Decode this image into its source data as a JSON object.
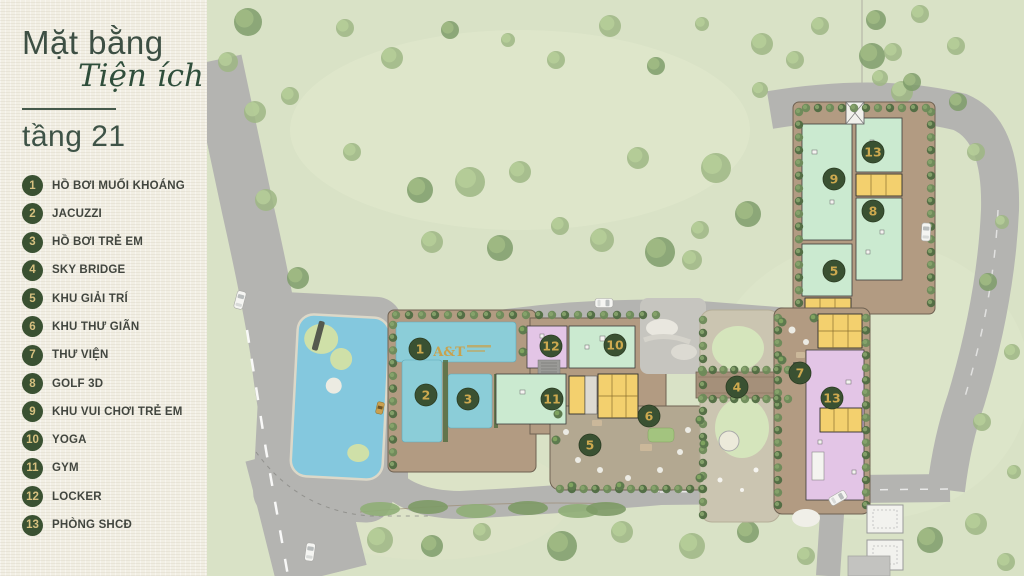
{
  "panel": {
    "title_line1": "Mặt bằng",
    "title_line2": "Tiện ích",
    "floor": "tầng 21",
    "items": [
      {
        "number": "1",
        "label": "HỒ BƠI MUỐI KHOÁNG"
      },
      {
        "number": "2",
        "label": "JACUZZI"
      },
      {
        "number": "3",
        "label": "HỒ BƠI TRẺ EM"
      },
      {
        "number": "4",
        "label": "SKY BRIDGE"
      },
      {
        "number": "5",
        "label": "KHU GIẢI TRÍ"
      },
      {
        "number": "6",
        "label": "KHU THƯ GIÃN"
      },
      {
        "number": "7",
        "label": "THƯ VIỆN"
      },
      {
        "number": "8",
        "label": "GOLF 3D"
      },
      {
        "number": "9",
        "label": "KHU VUI CHƠI TRẺ EM"
      },
      {
        "number": "10",
        "label": "YOGA"
      },
      {
        "number": "11",
        "label": "GYM"
      },
      {
        "number": "12",
        "label": "LOCKER"
      },
      {
        "number": "13",
        "label": "PHÒNG SHCĐ"
      }
    ]
  },
  "map": {
    "pool_logo": "A&T",
    "markers": [
      {
        "number": "1",
        "area": "ho-boi-muoi-khoang"
      },
      {
        "number": "2",
        "area": "jacuzzi"
      },
      {
        "number": "3",
        "area": "ho-boi-tre-em"
      },
      {
        "number": "12",
        "area": "locker"
      },
      {
        "number": "10",
        "area": "yoga"
      },
      {
        "number": "11",
        "area": "gym"
      },
      {
        "number": "5",
        "area": "khu-giai-tri"
      },
      {
        "number": "6",
        "area": "khu-thu-gian"
      },
      {
        "number": "4",
        "area": "sky-bridge"
      },
      {
        "number": "7",
        "area": "thu-vien"
      },
      {
        "number": "13",
        "area": "phong-shcd"
      },
      {
        "number": "9",
        "area": "khu-vui-choi-tre-em"
      },
      {
        "number": "13",
        "area": "phong-shcd"
      },
      {
        "number": "8",
        "area": "golf-3d"
      },
      {
        "number": "5",
        "area": "khu-giai-tri"
      }
    ],
    "colors": {
      "panel_bg": "#f2efe4",
      "title_green": "#3d4f44",
      "marker_bg": "#3a5132",
      "marker_number": "#cda94f",
      "grass": "#d9e2c6",
      "water": "#84c8de",
      "pool": "#8bcdd8",
      "room_mint": "#cbead0",
      "room_purple": "#e3c5e6",
      "room_yellow": "#f3d06e",
      "building_tan": "#b29b82",
      "road_gray": "#b4b4b1"
    }
  }
}
